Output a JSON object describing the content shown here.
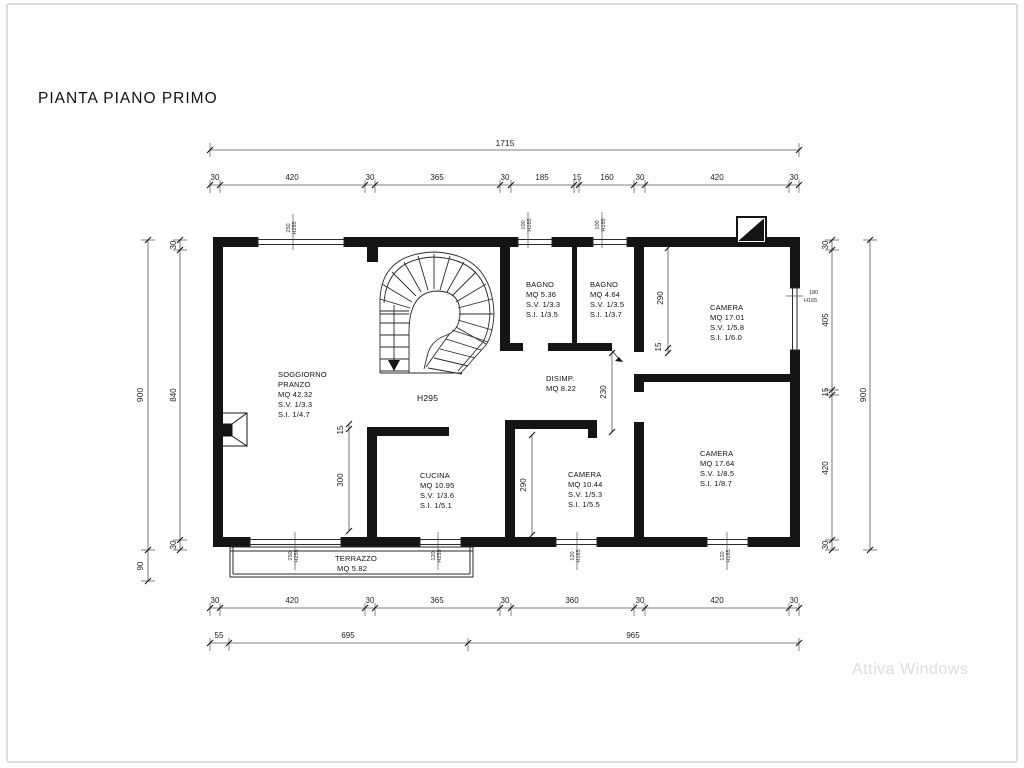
{
  "page": {
    "title": "PIANTA PIANO PRIMO",
    "watermark": "Attiva Windows"
  },
  "rooms": {
    "soggiorno": {
      "l1": "SOGGIORNO",
      "l2": "PRANZO",
      "l3": "MQ 42.32",
      "l4": "S.V. 1/3.3",
      "l5": "S.I. 1/4.7"
    },
    "bagno1": {
      "l1": "BAGNO",
      "l2": "MQ 5.36",
      "l3": "S.V. 1/3.3",
      "l4": "S.I. 1/3.5"
    },
    "bagno2": {
      "l1": "BAGNO",
      "l2": "MQ 4.64",
      "l3": "S.V. 1/3.5",
      "l4": "S.I. 1/3.7"
    },
    "camera1": {
      "l1": "CAMERA",
      "l2": "MQ 17.01",
      "l3": "S.V. 1/5.8",
      "l4": "S.I. 1/6.0"
    },
    "camera2": {
      "l1": "CAMERA",
      "l2": "MQ 10.44",
      "l3": "S.V. 1/5.3",
      "l4": "S.I. 1/5.5"
    },
    "camera3": {
      "l1": "CAMERA",
      "l2": "MQ 17.64",
      "l3": "S.V. 1/8.5",
      "l4": "S.I. 1/8.7"
    },
    "cucina": {
      "l1": "CUCINA",
      "l2": "MQ 10.95",
      "l3": "S.V. 1/3.6",
      "l4": "S.I. 1/5.1"
    },
    "disimp": {
      "l1": "DISIMP.",
      "l2": "MQ 8.22"
    },
    "terrazzo": {
      "l1": "TERRAZZO",
      "l2": "MQ 5.82"
    },
    "stair_height": "H295"
  },
  "dims": {
    "top_total": "1715",
    "top_row": [
      "30",
      "420",
      "30",
      "365",
      "30",
      "185",
      "15",
      "160",
      "30",
      "420",
      "30"
    ],
    "bottom_row": [
      "30",
      "420",
      "30",
      "365",
      "30",
      "360",
      "30",
      "420",
      "30"
    ],
    "bottom_total": [
      "55",
      "695",
      "965"
    ],
    "left_outer": "900",
    "left_terrace": "90",
    "left_inner": [
      "30",
      "840",
      "30"
    ],
    "right_inner": [
      "30",
      "405",
      "15",
      "420",
      "30"
    ],
    "right_outer": "900",
    "interior": {
      "c1_290": "290",
      "c1_15": "15",
      "disimp_230": "230",
      "c2_290": "290",
      "sog_15": "15",
      "sog_300": "300"
    }
  },
  "window_tags": {
    "t1": {
      "w": "250",
      "h": "H255"
    },
    "t2": {
      "w": "100",
      "h": "H165"
    },
    "t3": {
      "w": "100",
      "h": "H165"
    },
    "t4": {
      "w": "180",
      "h": "H165"
    },
    "b1": {
      "w": "250",
      "h": "H255"
    },
    "b2": {
      "w": "120",
      "h": "H255"
    },
    "b3": {
      "w": "120",
      "h": "H165"
    },
    "b4": {
      "w": "120",
      "h": "H165"
    }
  }
}
